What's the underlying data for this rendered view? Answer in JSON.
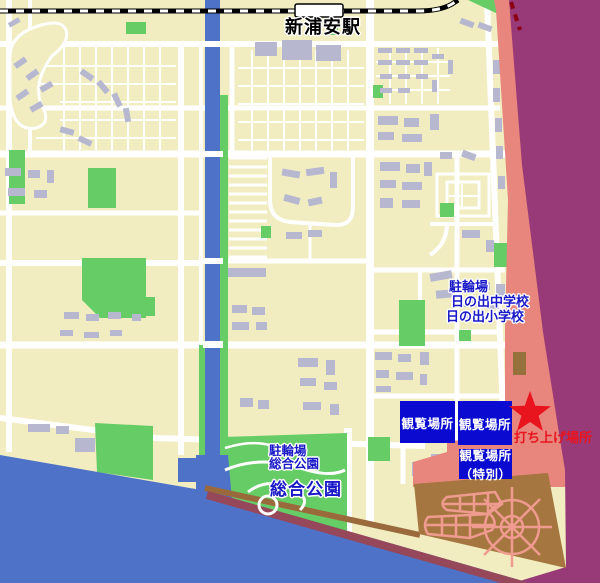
{
  "map": {
    "station_label": "新浦安駅",
    "northeast_labels": {
      "bike": "駐輪場",
      "middle_school": "日の出中学校",
      "elementary_school": "日の出小学校"
    },
    "viewing_area_left": "観覧場所",
    "viewing_area_right": "観覧場所",
    "viewing_area_special": {
      "line1": "観覧場所",
      "line2": "（特別）"
    },
    "launch_label": "打ち上げ場所",
    "park_labels": {
      "bike": "駐輪場",
      "park": "総合公園"
    },
    "park_name_large": "総合公園"
  },
  "colors": {
    "land": "#f1edc1",
    "road": "#ffffff",
    "park_green": "#66cc66",
    "building_gray": "#b7b8d0",
    "water_blue": "#4d72c8",
    "bay_purple": "#993a78",
    "overlay_salmon": "#e8857d",
    "sports_park_brown": "#a5763f",
    "path_pink": "#ef9b8f",
    "viewing_area_blue": "#0a0ad0",
    "label_blue": "#1818c8",
    "launch_red": "#e8141e",
    "coast_maroon": "#96475a",
    "coast_tan": "#9b6a3c",
    "railway_black": "#000000"
  }
}
